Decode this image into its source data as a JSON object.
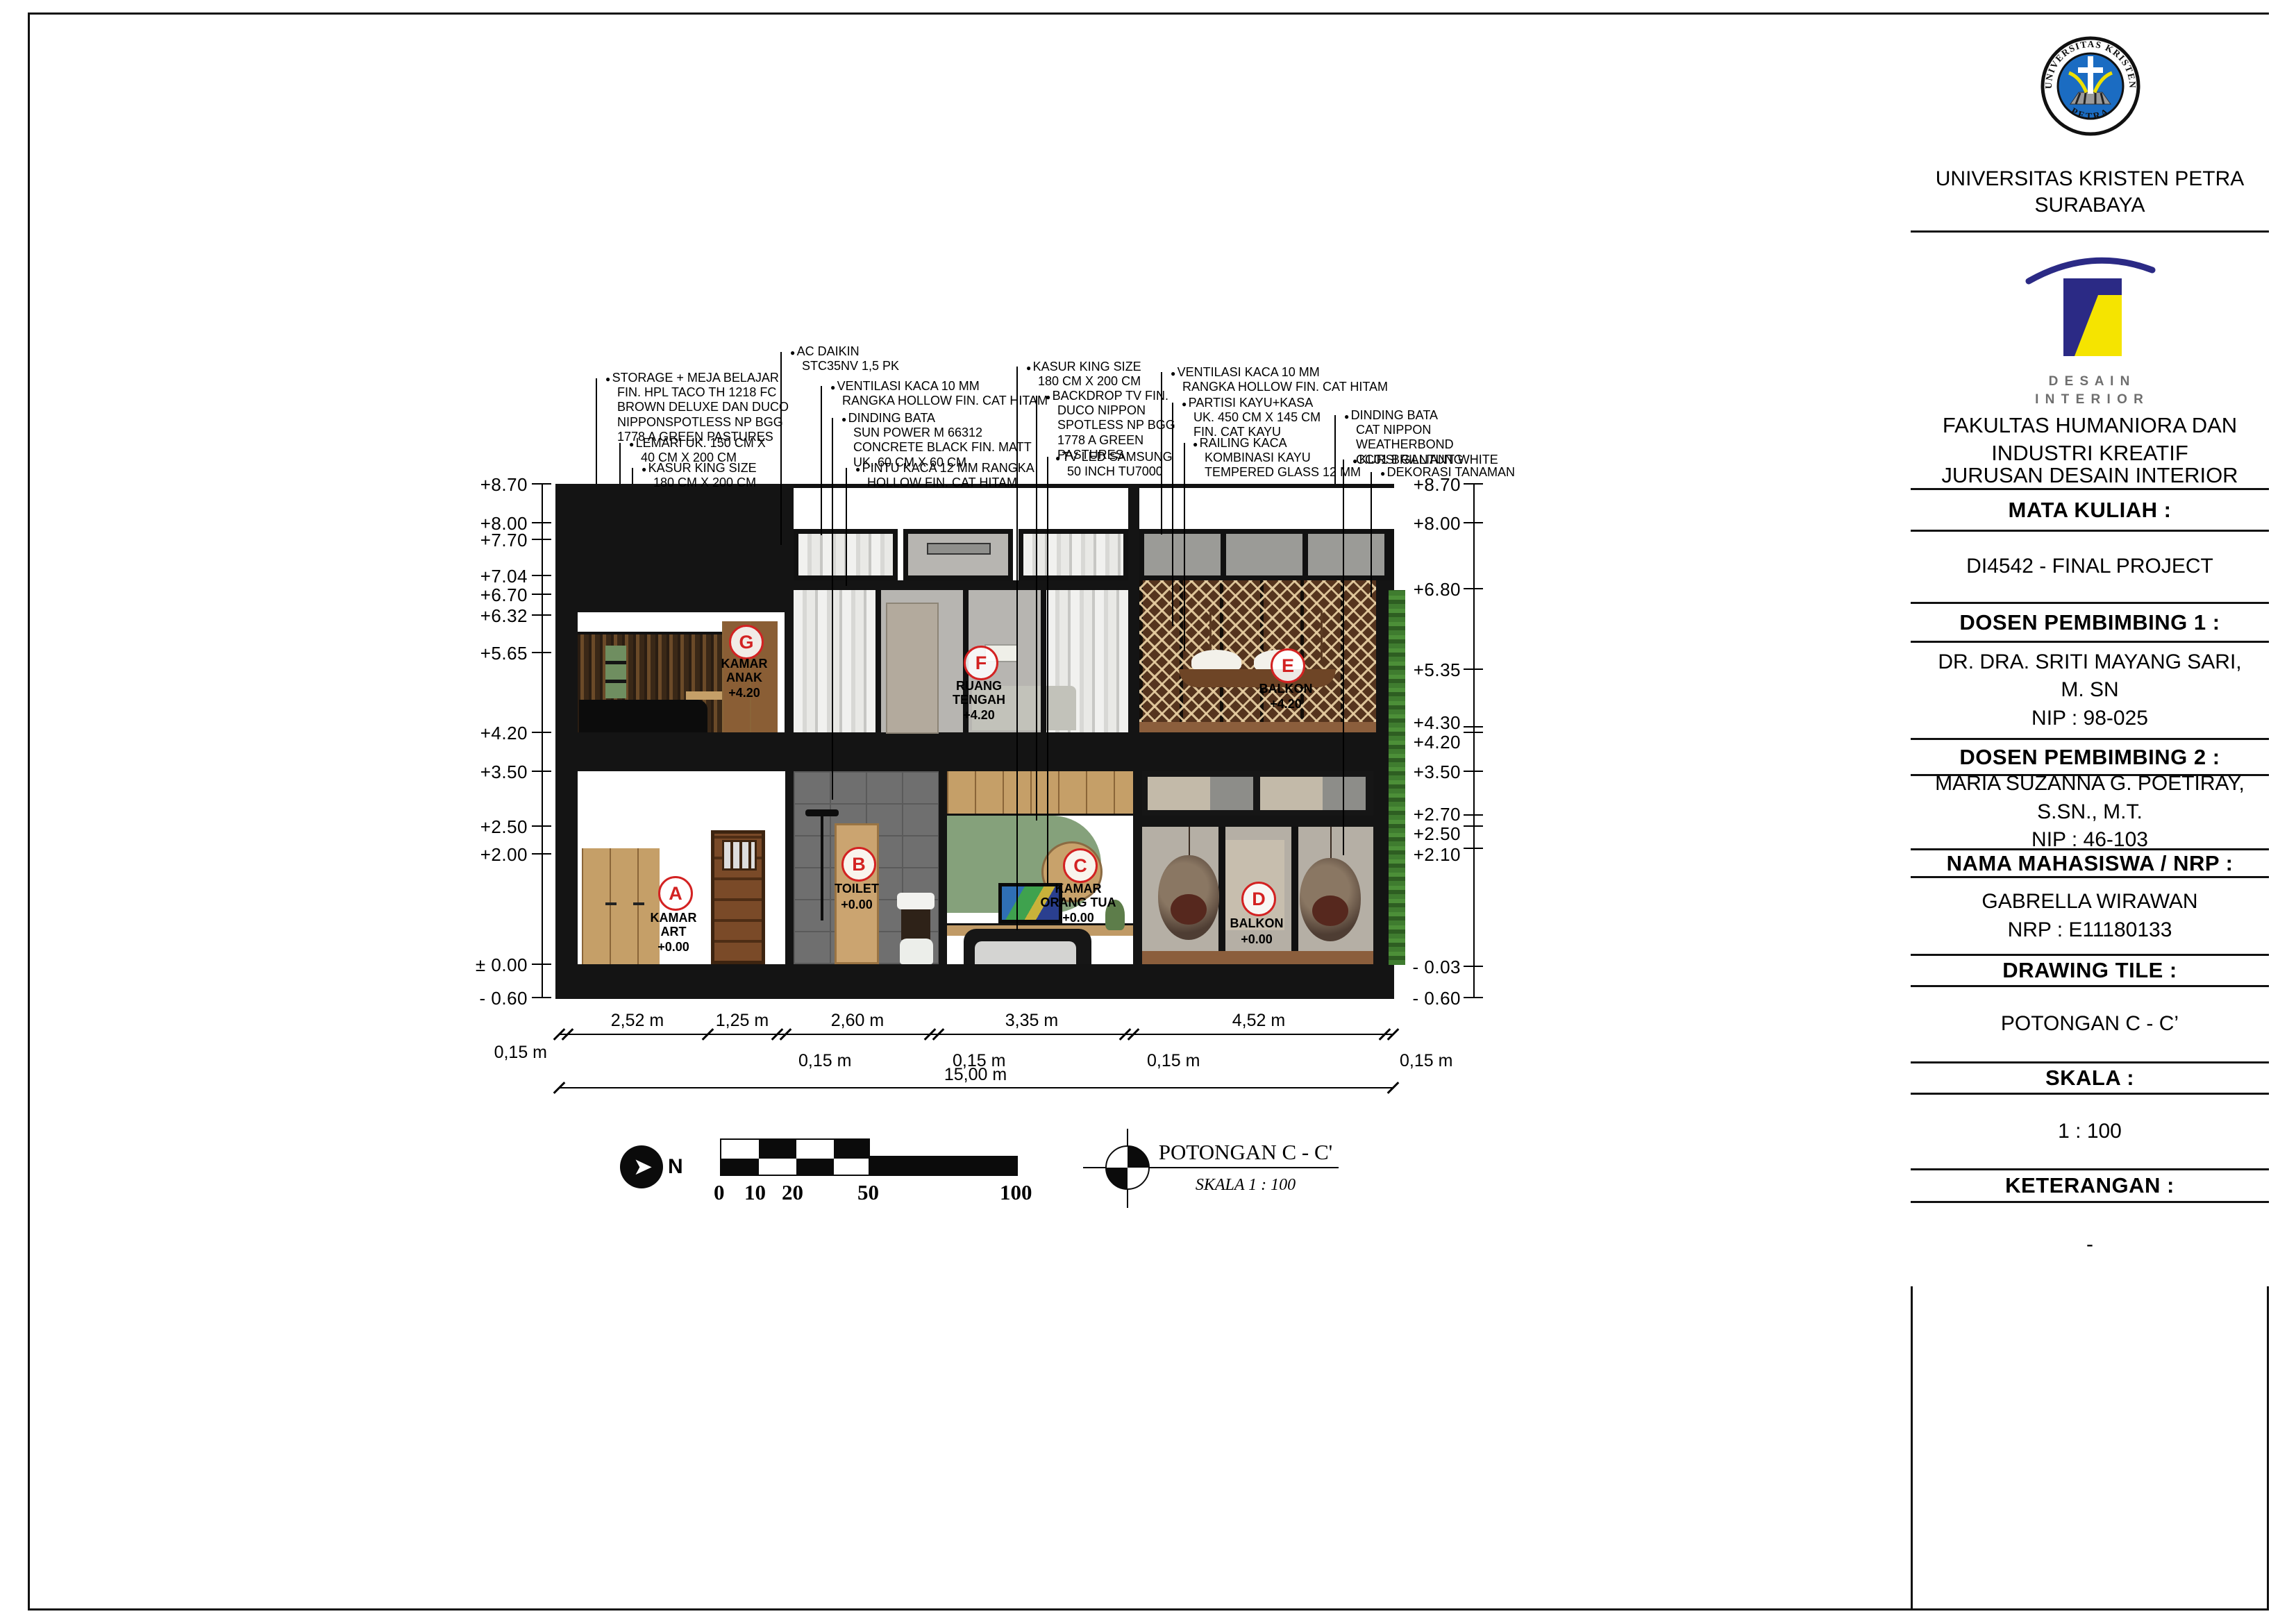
{
  "titleblock": {
    "university_ring_top": "UNIVERSITAS KRISTEN",
    "university_ring_bottom": "PETRA",
    "university": "UNIVERSITAS KRISTEN PETRA\nSURABAYA",
    "di_logo": "D E S A I N\nI N T E R I O R",
    "fakultas": "FAKULTAS HUMANIORA DAN\nINDUSTRI KREATIF",
    "jurusan": "JURUSAN DESAIN INTERIOR",
    "mata_kuliah_label": "MATA KULIAH :",
    "mata_kuliah": "DI4542 - FINAL PROJECT",
    "dosen1_label": "DOSEN PEMBIMBING 1 :",
    "dosen1": "DR. DRA. SRITI MAYANG SARI,\nM. SN\nNIP : 98-025",
    "dosen2_label": "DOSEN PEMBIMBING 2 :",
    "dosen2": "MARIA SUZANNA G. POETIRAY,\nS.SN., M.T.\nNIP : 46-103",
    "nama_label": "NAMA MAHASISWA / NRP :",
    "nama": "GABRELLA WIRAWAN\nNRP : E11180133",
    "drawing_title_label": "DRAWING TILE :",
    "drawing_title": "POTONGAN C - C’",
    "skala_label": "SKALA :",
    "skala": "1 : 100",
    "keterangan_label": "KETERANGAN :",
    "keterangan": "-"
  },
  "drawing": {
    "title": "POTONGAN C - C'",
    "scale_note": "SKALA 1 : 100",
    "north": "N"
  },
  "annotations": [
    "STORAGE + MEJA BELAJAR\nFIN. HPL TACO TH 1218 FC\nBROWN DELUXE DAN DUCO\nNIPPONSPOTLESS NP BGG\n1778 A GREEN PASTURES",
    "LEMARI UK. 150 CM X\n40 CM X 200 CM",
    "KASUR KING SIZE\n180 CM X 200 CM",
    "AC DAIKIN\nSTC35NV 1,5 PK",
    "VENTILASI KACA 10 MM\nRANGKA HOLLOW FIN. CAT HITAM",
    "DINDING BATA\nSUN POWER M 66312\nCONCRETE BLACK FIN. MATT\nUK. 60 CM X 60 CM",
    "PINTU KACA 12 MM RANGKA\nHOLLOW FIN. CAT HITAM",
    "KASUR KING SIZE\n180 CM X 200 CM",
    "BACKDROP TV FIN.\nDUCO NIPPON\nSPOTLESS NP BGG\n1778 A GREEN\nPASTURES",
    "TV LED SAMSUNG\n50 INCH TU7000",
    "VENTILASI KACA 10 MM\nRANGKA HOLLOW FIN. CAT HITAM",
    "PARTISI KAYU+KASA\nUK. 450 CM X 145 CM\nFIN. CAT KAYU",
    "RAILING KACA\nKOMBINASI KAYU\nTEMPERED GLASS 12 MM",
    "DINDING BATA\nCAT NIPPON WEATHERBOND\nCC01 BRILLIANT WHITE",
    "KURSI GANTUNG",
    "DEKORASI TANAMAN"
  ],
  "elev_left": [
    "+8.70",
    "+8.00",
    "+7.70",
    "+7.04",
    "+6.70",
    "+6.32",
    "+5.65",
    "+4.20",
    "+3.50",
    "+2.50",
    "+2.00",
    "± 0.00",
    "- 0.60"
  ],
  "elev_right": [
    "+8.70",
    "+8.00",
    "+6.80",
    "+5.35",
    "+4.30",
    "+4.20",
    "+3.50",
    "+2.70",
    "+2.50",
    "+2.10",
    "- 0.03",
    "- 0.60"
  ],
  "rooms": [
    {
      "letter": "A",
      "name": "KAMAR\nART",
      "level": "+0.00"
    },
    {
      "letter": "B",
      "name": "TOILET",
      "level": "+0.00"
    },
    {
      "letter": "C",
      "name": "KAMAR\nORANG TUA",
      "level": "+0.00"
    },
    {
      "letter": "D",
      "name": "BALKON",
      "level": "+0.00"
    },
    {
      "letter": "E",
      "name": "BALKON",
      "level": "+4.20"
    },
    {
      "letter": "F",
      "name": "RUANG\nTENGAH",
      "level": "+4.20"
    },
    {
      "letter": "G",
      "name": "KAMAR\nANAK",
      "level": "+4.20"
    }
  ],
  "dimensions": {
    "segments": [
      "2,52 m",
      "1,25 m",
      "2,60 m",
      "3,35 m",
      "4,52 m"
    ],
    "wall": "0,15 m",
    "total": "15,00 m"
  },
  "scalebar": [
    "0",
    "10",
    "20",
    "50",
    "100"
  ]
}
